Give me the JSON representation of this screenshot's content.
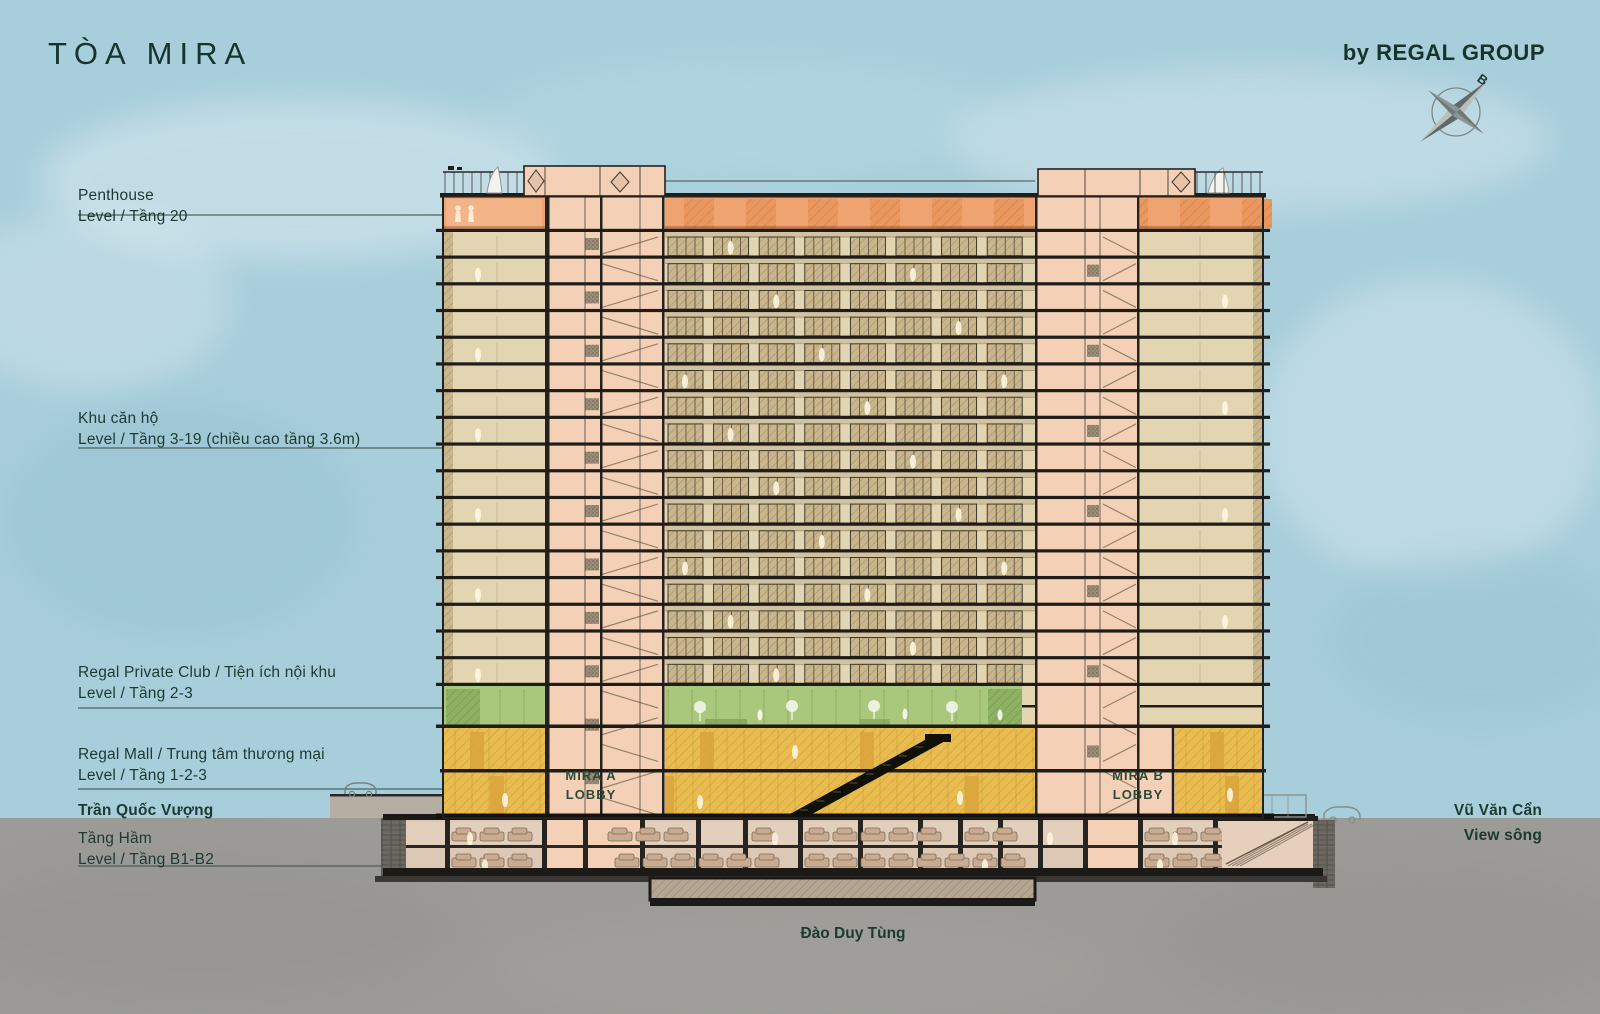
{
  "header": {
    "title": "TÒA MIRA",
    "brand": "by REGAL GROUP",
    "compass_north": "B"
  },
  "labels": {
    "penthouse_1": "Penthouse",
    "penthouse_2": "Level / Tầng 20",
    "apartments_1": "Khu căn hộ",
    "apartments_2": "Level / Tầng 3-19 (chiều cao tầng 3.6m)",
    "club_1": "Regal Private Club / Tiện ích nội khu",
    "club_2": "Level / Tầng 2-3",
    "mall_1": "Regal Mall / Trung tâm thương mại",
    "mall_2": "Level / Tầng 1-2-3",
    "street_left": "Trần Quốc Vượng",
    "basement_1": "Tầng Hầm",
    "basement_2": "Level / Tầng B1-B2",
    "street_right": "Vũ Văn Cẩn",
    "view_right": "View sông",
    "street_bottom": "Đào Duy Tùng",
    "lobby_a_1": "MIRA A",
    "lobby_a_2": "LOBBY",
    "lobby_b_1": "MIRA B",
    "lobby_b_2": "LOBBY"
  },
  "building": {
    "typical_floor_count": 17,
    "penthouse_level": 20,
    "apartment_levels": "3-19",
    "club_levels": "2-3",
    "mall_levels": "1-2-3",
    "basement_levels": "B1-B2"
  },
  "colors": {
    "sky": "#a8cedb",
    "ground": "#9c9b97",
    "text_green": "#1c3a31",
    "floor_beige": "#e4d5b2",
    "window_tan": "#c9b68d",
    "spandrel": "#d2c2a0",
    "penthouse_orange": "#efa370",
    "club_green": "#aac87c",
    "mall_yellow": "#e9bc4f",
    "core_pink": "#f3d0b6",
    "slab_black": "#1f1d19",
    "basement_tan": "#dcc8b4",
    "car_tan": "#c8ab90",
    "retaining_wall": "#6b6862"
  }
}
